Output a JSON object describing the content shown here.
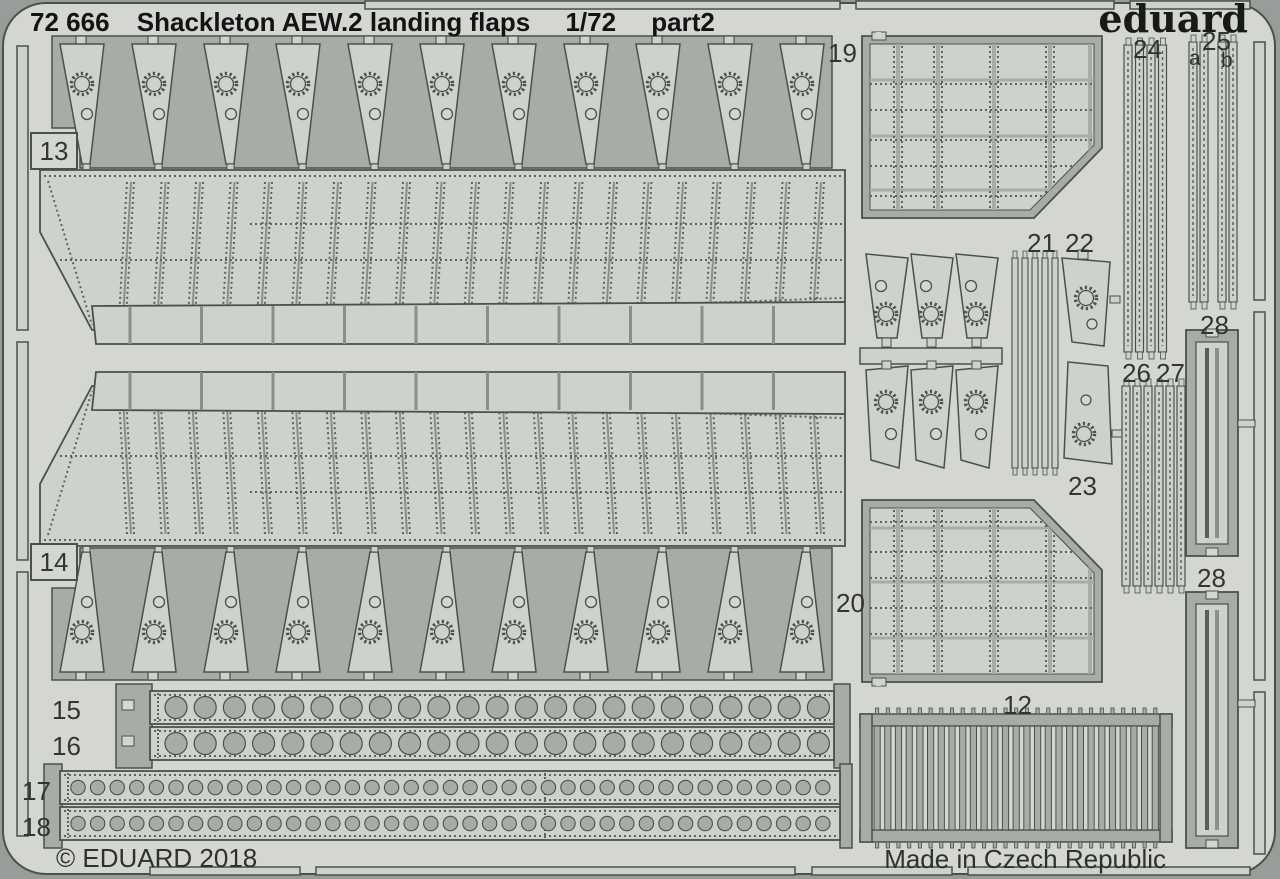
{
  "header": {
    "catalog_number": "72 666",
    "title": "Shackleton AEW.2 landing flaps",
    "scale": "1/72",
    "part": "part2"
  },
  "brand": {
    "logo": "eduard"
  },
  "footer": {
    "copyright": "© EDUARD 2018",
    "origin": "Made in Czech Republic"
  },
  "colors": {
    "background": "#d3d6d1",
    "metal": "#a8aca7",
    "part_surface": "#ced2cd",
    "outline": "#4c504d",
    "etch_dots": "#5f635f",
    "text": "#1a1c1a"
  },
  "parts": {
    "p12": {
      "label": "12"
    },
    "p13": {
      "label": "13"
    },
    "p14": {
      "label": "14"
    },
    "p15": {
      "label": "15"
    },
    "p16": {
      "label": "16"
    },
    "p17": {
      "label": "17"
    },
    "p18": {
      "label": "18"
    },
    "p19": {
      "label": "19"
    },
    "p20": {
      "label": "20"
    },
    "p21": {
      "label": "21"
    },
    "p22": {
      "label": "22"
    },
    "p23": {
      "label": "23"
    },
    "p24": {
      "label": "24"
    },
    "p25": {
      "label": "25"
    },
    "p25a": {
      "label": "a"
    },
    "p25b": {
      "label": "b"
    },
    "p26": {
      "label": "26"
    },
    "p27": {
      "label": "27"
    },
    "p28_top": {
      "label": "28"
    },
    "p28_bottom": {
      "label": "28"
    }
  }
}
